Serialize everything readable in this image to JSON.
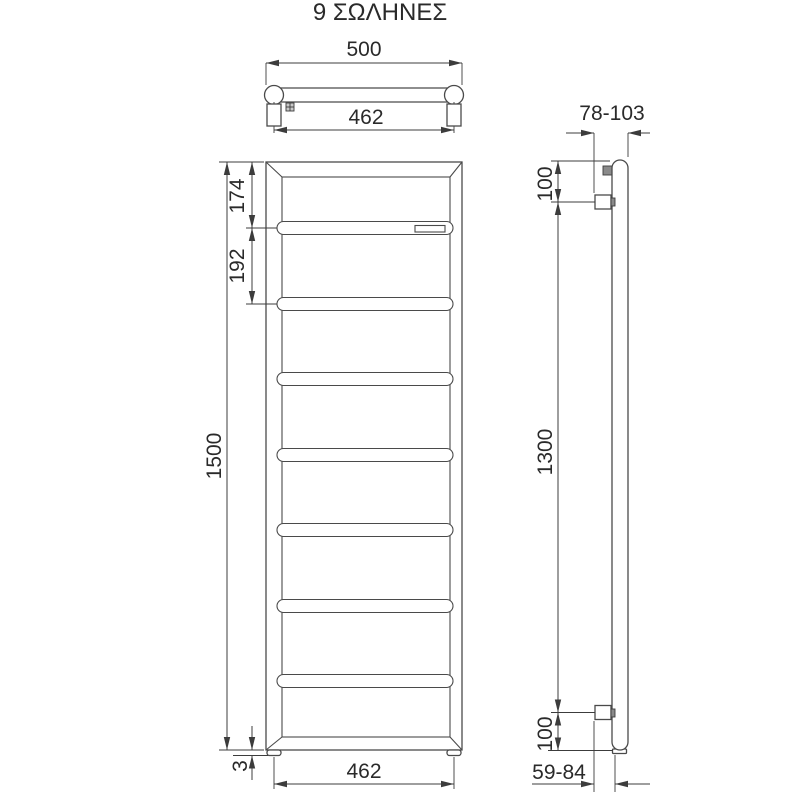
{
  "title": "9 ΣΩΛΗΝΕΣ",
  "colors": {
    "line": "#4a4a4a",
    "dimension_line": "#3c3c3c",
    "text": "#2a2a2a",
    "background": "#ffffff"
  },
  "top_view": {
    "overall_width": "500",
    "bracket_spacing": "462"
  },
  "front_view": {
    "top_to_first_tube": "174",
    "tube_spacing": "192",
    "overall_height": "1500",
    "foot_height": "3",
    "foot_spacing": "462"
  },
  "side_view": {
    "depth_with_bracket": "78-103",
    "top_bracket_to_top": "100",
    "bracket_distance": "1300",
    "bottom_bracket_to_bottom": "100",
    "wall_to_tube": "59-84"
  }
}
